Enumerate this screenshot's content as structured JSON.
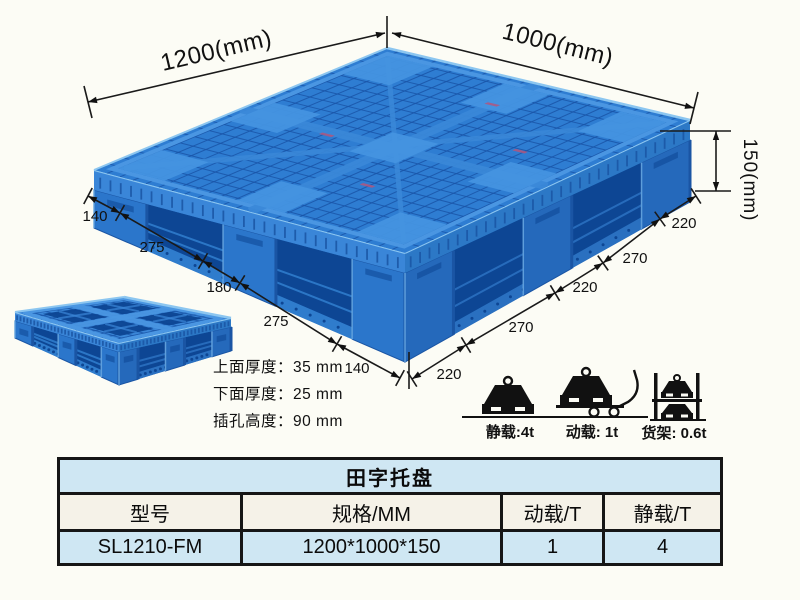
{
  "product_diagram": {
    "dim_width_label": "1200(mm)",
    "dim_depth_label": "1000(mm)",
    "dim_height_label": "150(mm)",
    "left_edge_segments": [
      "140",
      "275",
      "180",
      "275",
      "140"
    ],
    "right_edge_segments": [
      "220",
      "270",
      "220",
      "270",
      "220"
    ]
  },
  "thickness_notes": [
    "上面厚度：35 mm",
    "下面厚度：25 mm",
    "插孔高度：90 mm"
  ],
  "load_ratings": [
    {
      "icon": "static-load-icon",
      "label": "静载:4t"
    },
    {
      "icon": "dynamic-load-icon",
      "label": "动载: 1t"
    },
    {
      "icon": "rack-load-icon",
      "label": "货架: 0.6t"
    }
  ],
  "spec_table": {
    "title": "田字托盘",
    "headers": [
      "型号",
      "规格/MM",
      "动载/T",
      "静载/T"
    ],
    "rows": [
      [
        "SL1210-FM",
        "1200*1000*150",
        "1",
        "4"
      ]
    ]
  },
  "colors": {
    "background": "#fcfcf5",
    "pallet_blue": "#2e7dd2",
    "pallet_dark_hole": "#0d4694",
    "pallet_highlight": "#5ea8e6",
    "line_color": "#1a1a1a",
    "table_blue_row": "#cfe7f3",
    "table_header_bg": "#f5f2e8",
    "table_border": "#161616"
  }
}
